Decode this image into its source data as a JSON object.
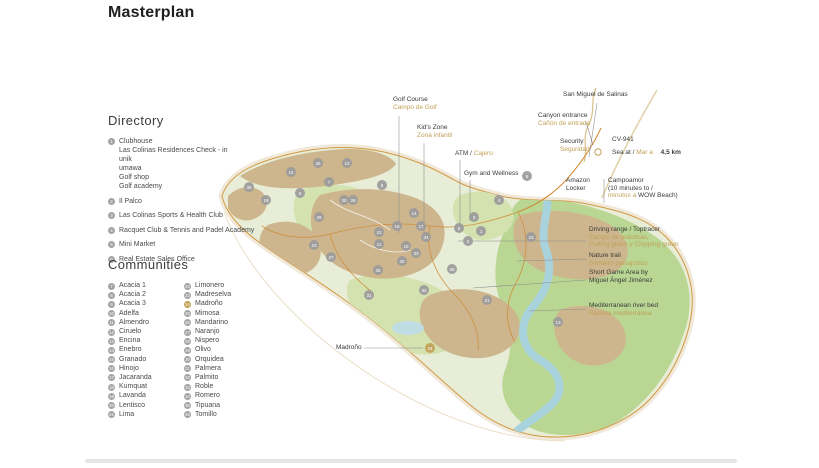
{
  "title": "Masterplan",
  "directory": {
    "heading": "Directory",
    "items": [
      {
        "num": "1",
        "label": "Clubhouse",
        "sublines": [
          "Las Colinas Residences Check - in",
          "unik",
          "umawa",
          "Golf shop",
          "Golf academy"
        ]
      },
      {
        "num": "2",
        "label": "Il Palco",
        "sublines": []
      },
      {
        "num": "3",
        "label": "Las Colinas Sports & Health Club",
        "sublines": []
      },
      {
        "num": "4",
        "label": "Racquet Club & Tennis and Padel Academy",
        "sublines": []
      },
      {
        "num": "5",
        "label": "Mini Market",
        "sublines": []
      },
      {
        "num": "6",
        "label": "Real Estate Sales Office",
        "sublines": []
      }
    ]
  },
  "communities": {
    "heading": "Communities",
    "column1": [
      {
        "num": "7",
        "label": "Acacia 1"
      },
      {
        "num": "8",
        "label": "Acacia 2"
      },
      {
        "num": "9",
        "label": "Acacia 3"
      },
      {
        "num": "10",
        "label": "Adelfa"
      },
      {
        "num": "11",
        "label": "Almendro"
      },
      {
        "num": "12",
        "label": "Ciruelo"
      },
      {
        "num": "13",
        "label": "Encina"
      },
      {
        "num": "14",
        "label": "Enebro"
      },
      {
        "num": "15",
        "label": "Granado"
      },
      {
        "num": "16",
        "label": "Hinojo"
      },
      {
        "num": "17",
        "label": "Jacaranda"
      },
      {
        "num": "18",
        "label": "Kumquat"
      },
      {
        "num": "19",
        "label": "Lavanda"
      },
      {
        "num": "20",
        "label": "Lentisco"
      },
      {
        "num": "21",
        "label": "Lima"
      }
    ],
    "column2": [
      {
        "num": "22",
        "label": "Limonero"
      },
      {
        "num": "23",
        "label": "Madreselva"
      },
      {
        "num": "24",
        "label": "Madroño",
        "highlighted": true
      },
      {
        "num": "25",
        "label": "Mimosa"
      },
      {
        "num": "26",
        "label": "Mandarino"
      },
      {
        "num": "27",
        "label": "Naranjo"
      },
      {
        "num": "28",
        "label": "Nispero"
      },
      {
        "num": "29",
        "label": "Olivo"
      },
      {
        "num": "30",
        "label": "Orquidea"
      },
      {
        "num": "31",
        "label": "Palmera"
      },
      {
        "num": "32",
        "label": "Palmito"
      },
      {
        "num": "33",
        "label": "Roble"
      },
      {
        "num": "34",
        "label": "Romero"
      },
      {
        "num": "35",
        "label": "Tipuana"
      },
      {
        "num": "36",
        "label": "Tomillo"
      }
    ]
  },
  "map": {
    "callouts": {
      "golf_course": {
        "en": "Golf Course",
        "es": "Campo de Golf"
      },
      "kids_zone": {
        "en": "Kid's Zone",
        "es": "Zona infantil"
      },
      "atm": {
        "en": "ATM / ",
        "es": "Cajero"
      },
      "gym": {
        "en": "Gym and Wellness"
      },
      "san_miguel": {
        "en": "San Miguel de Salinas"
      },
      "canyon": {
        "en": "Canyon entrance",
        "es": "Cañón de entrada"
      },
      "security": {
        "en": "Security",
        "es": "Seguridad"
      },
      "road": {
        "name": "CV-941"
      },
      "sea": {
        "en": "Sea at /",
        "es": "Mar a",
        "distance": "4,5 km"
      },
      "amazon": {
        "line1": "Amazon",
        "line2": "Locker"
      },
      "campoamor": {
        "line1": "Campoamor",
        "line2": "(10 minutes to /",
        "es": "minutos a ",
        "line3": "WOW Beach)"
      },
      "driving_range": {
        "en": "Driving range / Toptracer",
        "es1": "Campo de prácticas,",
        "es2": "Putting green y Chipping green"
      },
      "nature_trail": {
        "en": "Nature trail",
        "es": "Sendero paisajístico"
      },
      "short_game": {
        "line1": "Short Game Area by",
        "line2": "Miguel Ángel Jiménez"
      },
      "river_bed": {
        "en": "Mediterranean river bed",
        "es": "Rambla mediterránea"
      },
      "madrono": {
        "label": "Madroño"
      }
    },
    "markers": [
      {
        "n": "1",
        "x": 481,
        "y": 231
      },
      {
        "n": "2",
        "x": 468,
        "y": 241
      },
      {
        "n": "3",
        "x": 474,
        "y": 217
      },
      {
        "n": "4",
        "x": 499,
        "y": 200
      },
      {
        "n": "5",
        "x": 459,
        "y": 228
      },
      {
        "n": "6",
        "x": 527,
        "y": 176
      },
      {
        "n": "7",
        "x": 329,
        "y": 182
      },
      {
        "n": "8",
        "x": 382,
        "y": 185
      },
      {
        "n": "9",
        "x": 300,
        "y": 193
      },
      {
        "n": "10",
        "x": 314,
        "y": 245
      },
      {
        "n": "11",
        "x": 379,
        "y": 244
      },
      {
        "n": "12",
        "x": 347,
        "y": 163
      },
      {
        "n": "13",
        "x": 558,
        "y": 322
      },
      {
        "n": "14",
        "x": 414,
        "y": 213
      },
      {
        "n": "15",
        "x": 291,
        "y": 172
      },
      {
        "n": "16",
        "x": 397,
        "y": 226
      },
      {
        "n": "17",
        "x": 421,
        "y": 226
      },
      {
        "n": "18",
        "x": 266,
        "y": 200
      },
      {
        "n": "19",
        "x": 406,
        "y": 246
      },
      {
        "n": "20",
        "x": 344,
        "y": 200
      },
      {
        "n": "21",
        "x": 487,
        "y": 300
      },
      {
        "n": "22",
        "x": 379,
        "y": 232
      },
      {
        "n": "23",
        "x": 531,
        "y": 237
      },
      {
        "n": "24",
        "x": 430,
        "y": 348,
        "gold": true
      },
      {
        "n": "25",
        "x": 318,
        "y": 163
      },
      {
        "n": "26",
        "x": 452,
        "y": 269
      },
      {
        "n": "27",
        "x": 331,
        "y": 257
      },
      {
        "n": "28",
        "x": 353,
        "y": 200
      },
      {
        "n": "29",
        "x": 319,
        "y": 217
      },
      {
        "n": "30",
        "x": 402,
        "y": 261
      },
      {
        "n": "31",
        "x": 369,
        "y": 295
      },
      {
        "n": "32",
        "x": 424,
        "y": 290
      },
      {
        "n": "33",
        "x": 416,
        "y": 253
      },
      {
        "n": "34",
        "x": 426,
        "y": 237
      },
      {
        "n": "35",
        "x": 249,
        "y": 187
      },
      {
        "n": "36",
        "x": 378,
        "y": 270
      }
    ]
  },
  "colors": {
    "gold": "#C2A157",
    "marker_gray": "#9B9B9B",
    "map_green": "#E7EDD6",
    "map_green_dark": "#B0D187",
    "fairway": "#D3E2AE",
    "tan": "#CDB68E",
    "river": "#A9D3DC",
    "road": "#D08A35",
    "outline": "#D49843"
  }
}
